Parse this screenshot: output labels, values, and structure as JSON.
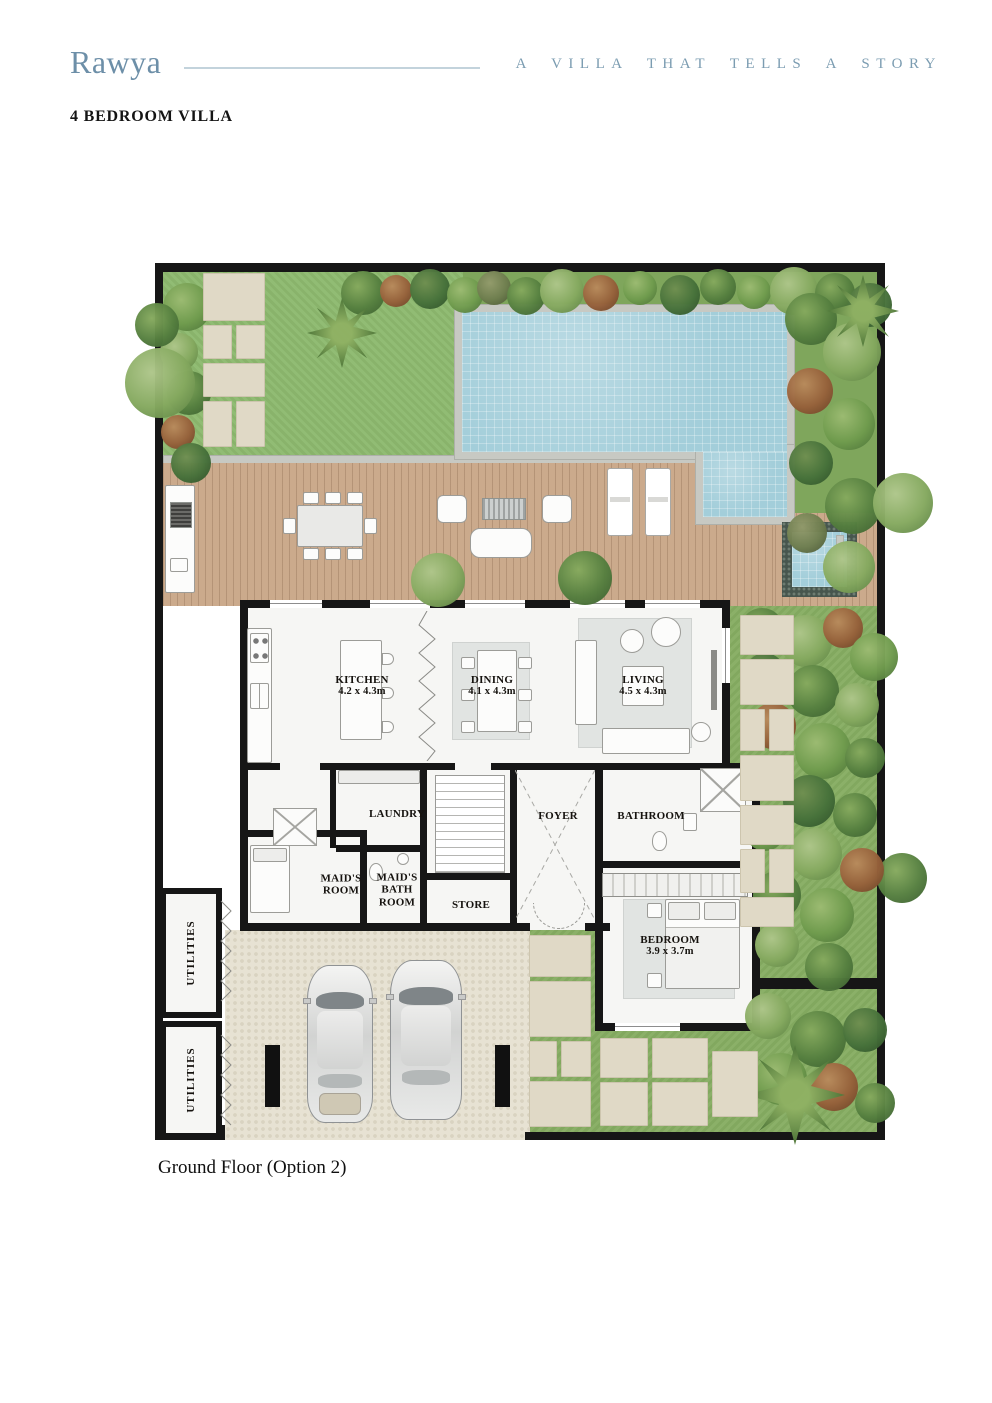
{
  "header": {
    "brand": "Rawya",
    "tagline": "A VILLA THAT TELLS A STORY",
    "subtitle": "4 BEDROOM VILLA"
  },
  "caption": "Ground Floor (Option 2)",
  "colors": {
    "brand_blue": "#6d8fa8",
    "divider_blue": "#c3d3dc",
    "text_dark": "#16130f",
    "pool_water": "#a3ceda",
    "lawn_green": "#8db96e",
    "deck_wood": "#cbaa8c",
    "wall_black": "#161616"
  },
  "plan": {
    "rooms": {
      "kitchen": {
        "name": "KITCHEN",
        "dims": "4.2 x 4.3m"
      },
      "dining": {
        "name": "DINING",
        "dims": "4.1 x 4.3m"
      },
      "living": {
        "name": "LIVING",
        "dims": "4.5 x 4.3m"
      },
      "bedroom": {
        "name": "BEDROOM",
        "dims": "3.9 x 3.7m"
      },
      "laundry": {
        "name": "LAUNDRY"
      },
      "foyer": {
        "name": "FOYER"
      },
      "bathroom": {
        "name": "BATHROOM"
      },
      "maids_room": {
        "name": "MAID'S ROOM"
      },
      "maids_bath": {
        "name": "MAID'S BATH ROOM"
      },
      "store": {
        "name": "STORE"
      },
      "utilities_a": {
        "name": "UTILITIES"
      },
      "utilities_b": {
        "name": "UTILITIES"
      }
    }
  }
}
